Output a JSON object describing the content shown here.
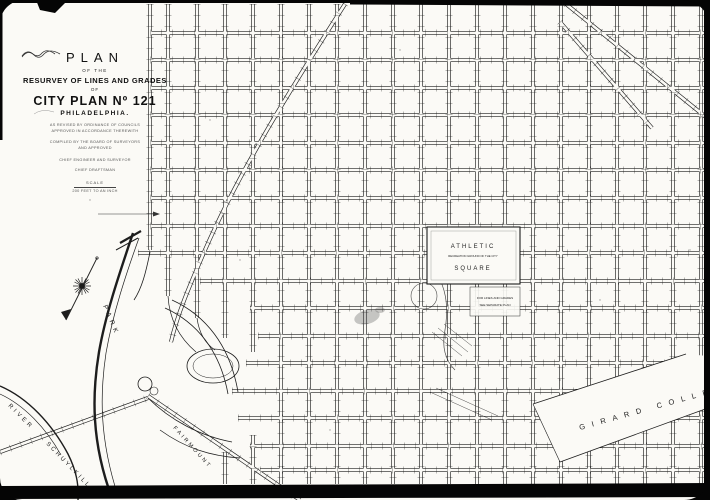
{
  "title_block": {
    "plan": "PLAN",
    "of_the": "OF THE",
    "resurvey": "RESURVEY OF LINES AND GRADES",
    "of": "OF",
    "city_plan": "CITY PLAN Nº 121",
    "city": "PHILADELPHIA.",
    "note1": "AS REVISED BY ORDINANCE OF COUNCILS",
    "note2": "APPROVED IN ACCORDANCE THEREWITH",
    "note3": "COMPILED BY THE BOARD OF SURVEYORS",
    "note4": "AND APPROVED",
    "sig1_caption": "CHIEF ENGINEER AND SURVEYOR",
    "sig2_caption": "CHIEF DRAFTSMAN",
    "scale_label": "SCALE",
    "scale_value": "200 FEET TO AN INCH"
  },
  "labels": {
    "park": "PARK",
    "river": "RIVER",
    "schuylkill": "SCHUYLKILL",
    "fairmount": "FAIRMOUNT",
    "girard_college": "GIRARD COLLEGE",
    "athletic_square": {
      "line1": "ATHLETIC",
      "line2": "RECREATION GROUND OF THE CITY",
      "line3": "SQUARE"
    },
    "plan_note": {
      "line1": "FOR LINES AND GRADES",
      "line2": "SEE SEPARATE PLAN"
    }
  },
  "colors": {
    "paper": "#fbfaf6",
    "ink": "#1d1d1d",
    "frame": "#050505"
  },
  "map": {
    "vertical_streets": [
      [
        150,
        4,
        250
      ],
      [
        168,
        4,
        296
      ],
      [
        197,
        4,
        318
      ],
      [
        225,
        4,
        338
      ],
      [
        225,
        452,
        484
      ],
      [
        253,
        4,
        352
      ],
      [
        253,
        435,
        484
      ],
      [
        281,
        4,
        484
      ],
      [
        309,
        4,
        484
      ],
      [
        337,
        4,
        484
      ],
      [
        365,
        4,
        484
      ],
      [
        393,
        4,
        484
      ],
      [
        421,
        4,
        484
      ],
      [
        449,
        4,
        484
      ],
      [
        477,
        4,
        484
      ],
      [
        505,
        4,
        484
      ],
      [
        533,
        4,
        484
      ],
      [
        561,
        4,
        484
      ],
      [
        589,
        4,
        484
      ],
      [
        617,
        4,
        484
      ],
      [
        645,
        4,
        484
      ],
      [
        673,
        4,
        484
      ],
      [
        701,
        4,
        484
      ]
    ],
    "horizontal_streets": [
      [
        33,
        150,
        706
      ],
      [
        60,
        150,
        706
      ],
      [
        88,
        150,
        706
      ],
      [
        115,
        150,
        706
      ],
      [
        143,
        150,
        706
      ],
      [
        170,
        150,
        706
      ],
      [
        198,
        150,
        706
      ],
      [
        226,
        150,
        706
      ],
      [
        253,
        138,
        706
      ],
      [
        281,
        200,
        706
      ],
      [
        308,
        250,
        706
      ],
      [
        336,
        258,
        706
      ],
      [
        363,
        246,
        706
      ],
      [
        391,
        232,
        706
      ],
      [
        418,
        238,
        706
      ],
      [
        446,
        250,
        706
      ],
      [
        470,
        260,
        706
      ]
    ],
    "diagonal_roads": [
      "M345,4 C290,90 240,170 205,250 C190,285 178,312 171,342",
      "M566,4 L712,122",
      "M560,22 L652,128",
      "M148,396 L300,500",
      "M0,452 L148,398"
    ]
  }
}
